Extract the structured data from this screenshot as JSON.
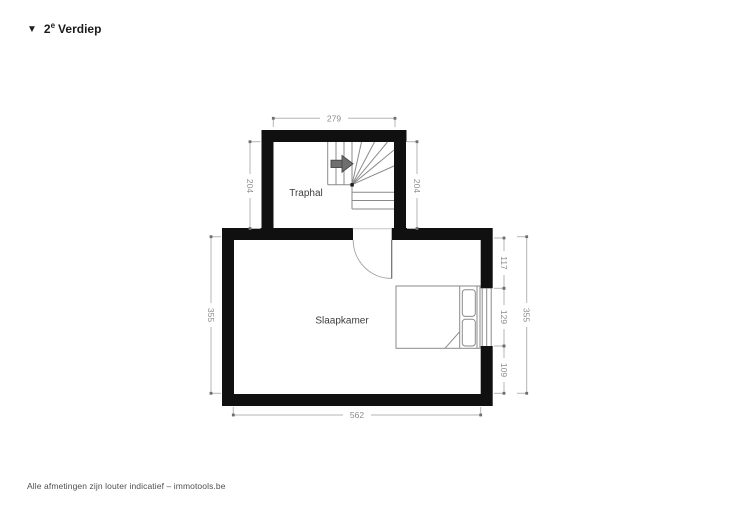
{
  "header": {
    "marker": "▼",
    "floor_number": "2",
    "floor_exponent": "e",
    "floor_label": "Verdiep"
  },
  "rooms": {
    "stairhall": "Traphal",
    "bedroom": "Slaapkamer"
  },
  "dimensions": {
    "stairhall_width": "279",
    "stairhall_height_left": "204",
    "stairhall_height_right": "204",
    "bedroom_height_left": "355",
    "right_segment_top": "117",
    "right_segment_window": "129",
    "right_segment_bottom": "109",
    "bedroom_height_right": "355",
    "bedroom_width": "562"
  },
  "footer": {
    "disclaimer": "Alle afmetingen zijn louter indicatief – immotools.be"
  },
  "icons": {
    "stair_direction": "arrow-right"
  },
  "colors": {
    "wall": "#101010",
    "stair_line": "#8a8a8a",
    "bed_line": "#8a8a8a",
    "door_line": "#a8a8a8",
    "dim_line": "#b5b5b5",
    "dim_tick": "#6e6e6e",
    "dim_text": "#8c8c8c",
    "room_label": "#3d3d3d",
    "arrow_fill": "#6f6f6f"
  }
}
